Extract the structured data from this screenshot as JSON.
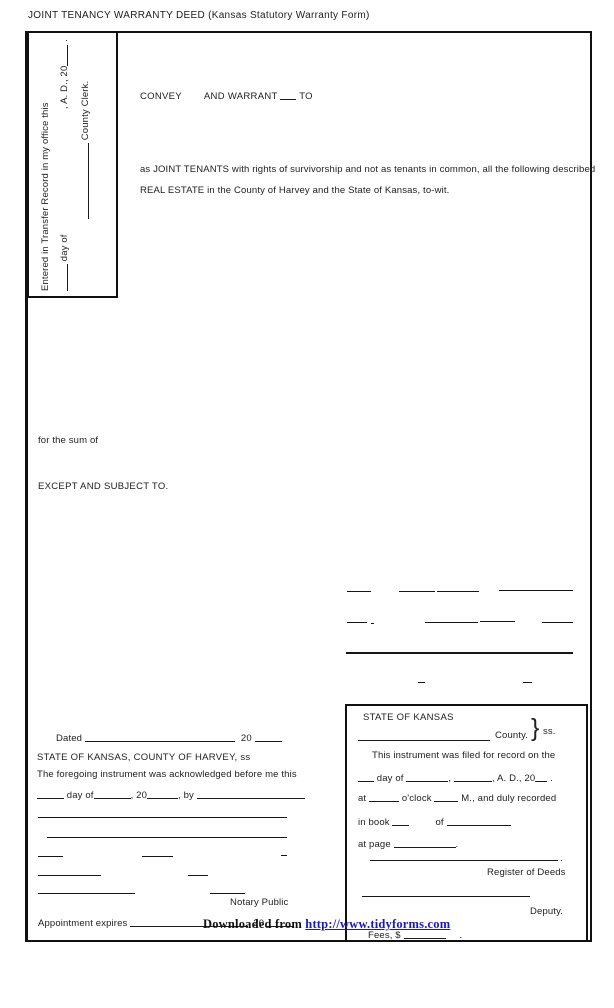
{
  "title": "JOINT TENANCY WARRANTY DEED (Kansas Statutory Warranty Form)",
  "transfer_record": {
    "entered_line": "Entered in Transfer Record in my office this",
    "day_of": "day of",
    "ad_20": ", A. D., 20",
    "period": ".",
    "county_clerk": "County Clerk."
  },
  "granting": {
    "convey": "CONVEY",
    "and_warrant": "AND WARRANT",
    "to": "TO",
    "joint_tenants_line1": "as JOINT TENANTS with rights of survivorship and not as tenants in common, all the following described",
    "joint_tenants_line2": "REAL ESTATE in the County of Harvey and the State of Kansas, to-wit.",
    "for_the_sum": "for the sum of",
    "except_subject": "EXCEPT AND SUBJECT TO."
  },
  "notary_section": {
    "dated": "Dated",
    "dated_year": "20",
    "state_county_ss": "STATE OF KANSAS, COUNTY OF HARVEY, ss",
    "foregoing": "The foregoing instrument was acknowledged before me this",
    "ack_day_of": "day of",
    "ack_year": ", 20",
    "ack_by": ", by",
    "notary_public": "Notary Public",
    "appointment_expires": "Appointment expires",
    "appointment_year": "20"
  },
  "recording_box": {
    "state": "STATE OF KANSAS",
    "county": "County.",
    "brace": "}",
    "ss": "ss.",
    "filed": "This instrument was filed for record on the",
    "day_of": "day of",
    "comma": ",",
    "ad_20": ", A. D., 20",
    "period": ".",
    "at": "at",
    "oclock": "o'clock",
    "m_recorded": "M., and duly recorded",
    "in_book": "in book",
    "of": "of",
    "at_page": "at page",
    "register_of_deeds": "Register of Deeds",
    "deputy": "Deputy.",
    "fees": "Fees, $"
  },
  "watermark": {
    "prefix": "Downloaded from",
    "url": "http://www.tidyforms.com"
  }
}
